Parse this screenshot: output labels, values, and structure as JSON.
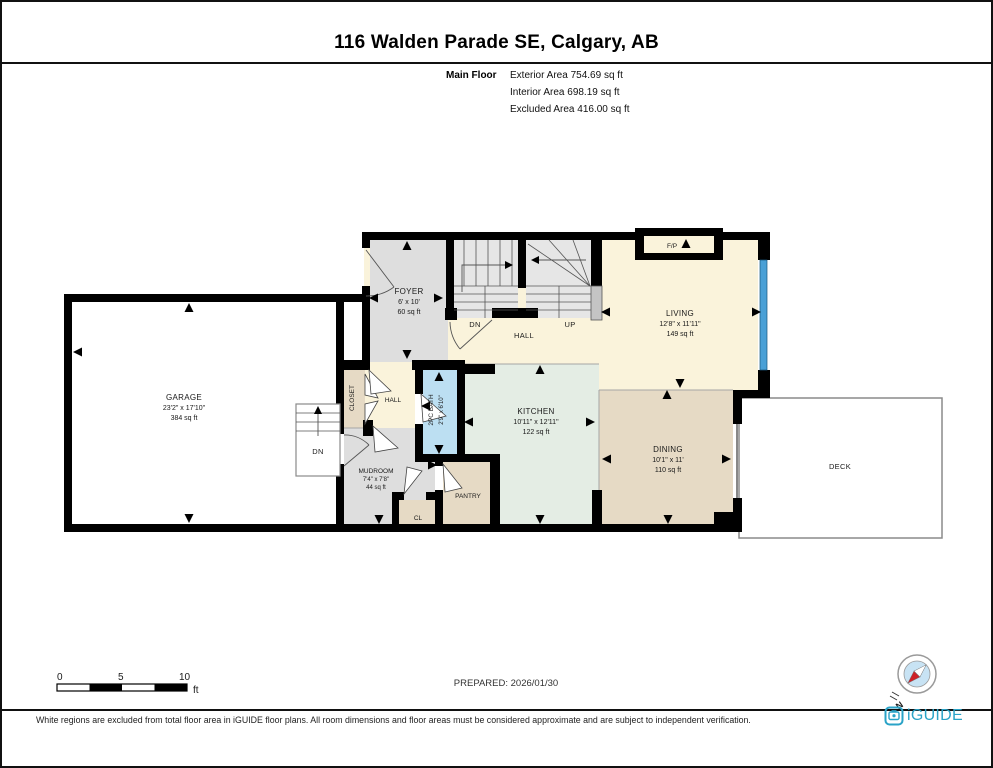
{
  "header": {
    "title": "116 Walden Parade SE, Calgary, AB",
    "floor_label": "Main Floor",
    "area_lines": [
      "Exterior Area 754.69 sq ft",
      "Interior Area 698.19 sq ft",
      "Excluded Area 416.00 sq ft"
    ]
  },
  "plan": {
    "garage": {
      "name": "GARAGE",
      "dims": "23'2\" x 17'10\"",
      "area": "384 sq ft"
    },
    "foyer": {
      "name": "FOYER",
      "dims": "6' x 10'",
      "area": "60 sq ft"
    },
    "living": {
      "name": "LIVING",
      "dims": "12'8\" x 11'11\"",
      "area": "149 sq ft"
    },
    "kitchen": {
      "name": "KITCHEN",
      "dims": "10'11\" x 12'11\"",
      "area": "122 sq ft"
    },
    "dining": {
      "name": "DINING",
      "dims": "10'1\" x 11'",
      "area": "110 sq ft"
    },
    "mudroom": {
      "name": "MUDROOM",
      "dims": "7'4\" x 7'8\"",
      "area": "44 sq ft"
    },
    "bath": {
      "name": "2PC BATH",
      "dims": "2'9\" x 6'10\""
    },
    "hall_upper": "HALL",
    "hall_lower": "HALL",
    "closet": "CLOSET",
    "pantry": "PANTRY",
    "cl": "CL",
    "deck": "DECK",
    "fireplace": "F/P",
    "stairs_up_label": "UP",
    "stairs_dn_label": "DN",
    "garage_stairs_label": "DN"
  },
  "scale_bar": {
    "ticks": [
      "0",
      "5",
      "10"
    ],
    "unit": "ft"
  },
  "footer": {
    "prepared": "PREPARED: 2026/01/30",
    "disclaimer": "White regions are excluded from total floor area in iGUIDE floor plans. All room dimensions and floor areas must be considered approximate and are subject to independent verification.",
    "brand": "iGUIDE",
    "compass_label": "N"
  },
  "colors": {
    "wall": "#000000",
    "window_blue": "#4AA0D6",
    "bath_fill": "#BCDFF2",
    "kitchen_fill": "#E4EDE4",
    "dining_fill": "#E6DAC5",
    "hall_fill": "#FAF3DB",
    "room_gray": "#DEDEDE",
    "brand_teal": "#2AA3C7",
    "compass_red": "#CE2127"
  }
}
